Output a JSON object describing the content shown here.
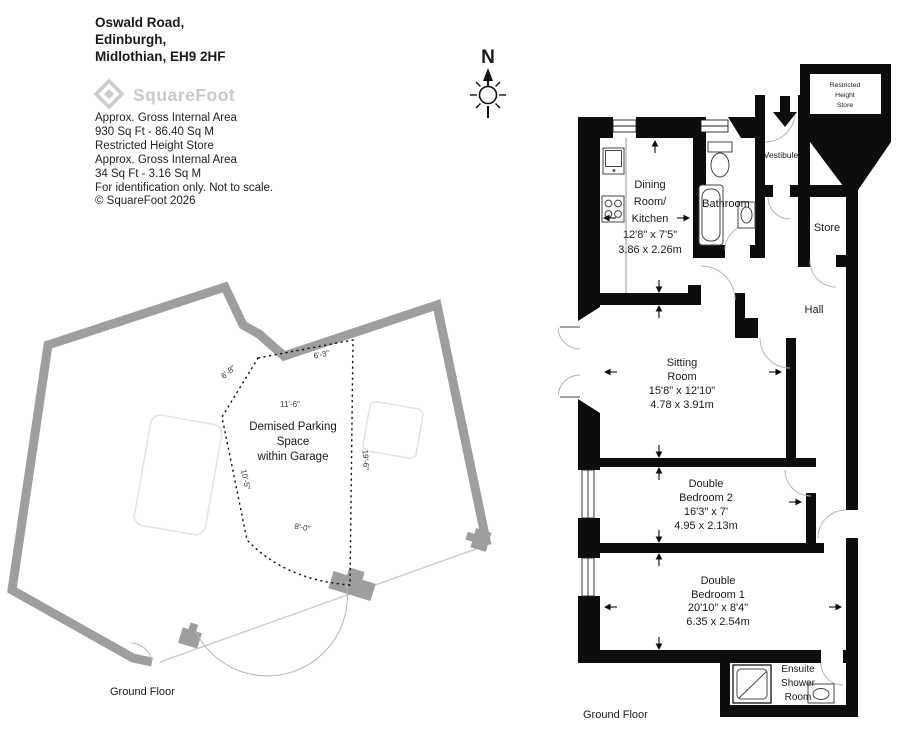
{
  "header": {
    "address_lines": [
      "Oswald Road,",
      "Edinburgh,",
      "Midlothian, EH9 2HF"
    ]
  },
  "logo": {
    "brand": "SquareFoot"
  },
  "area_info": {
    "lines": [
      "Approx. Gross Internal Area",
      "930 Sq Ft  -  86.40 Sq M",
      "Restricted Height Store",
      "Approx. Gross Internal Area",
      "34 Sq Ft  - 3.16 Sq M",
      "For identification only. Not to scale.",
      "© SquareFoot 2026"
    ]
  },
  "compass": {
    "north_label": "N"
  },
  "garage": {
    "floor_label": "Ground Floor",
    "parking_space": {
      "line1": "Demised Parking",
      "line2": "Space",
      "line3": "within Garage"
    },
    "dims": {
      "top_edge": "6'-3\"",
      "upper_left_edge": "6'-8\"",
      "inner_width": "11'-6\"",
      "right_edge": "19'-6\"",
      "lower_left_edge": "10'-5\"",
      "bottom_edge": "8'-0\""
    }
  },
  "flat": {
    "floor_label": "Ground Floor",
    "rooms": {
      "dining_kitchen": {
        "line1": "Dining",
        "line2": "Room/",
        "line3": "Kitchen",
        "imperial": "12'8\" x 7'5\"",
        "metric": "3.86 x 2.26m"
      },
      "bathroom": {
        "label": "Bathroom"
      },
      "vestibule": {
        "label": "Vestibule"
      },
      "restricted_store": {
        "line1": "Restricted",
        "line2": "Height",
        "line3": "Store"
      },
      "store": {
        "label": "Store"
      },
      "hall": {
        "label": "Hall"
      },
      "sitting": {
        "line1": "Sitting",
        "line2": "Room",
        "imperial": "15'8\" x 12'10\"",
        "metric": "4.78 x 3.91m"
      },
      "bedroom2": {
        "line1": "Double",
        "line2": "Bedroom 2",
        "imperial": "16'3\" x 7'",
        "metric": "4.95 x 2.13m"
      },
      "bedroom1": {
        "line1": "Double",
        "line2": "Bedroom 1",
        "imperial": "20'10\" x 8'4\"",
        "metric": "6.35 x 2.54m"
      },
      "ensuite": {
        "line1": "Ensuite",
        "line2": "Shower",
        "line3": "Room"
      }
    }
  }
}
